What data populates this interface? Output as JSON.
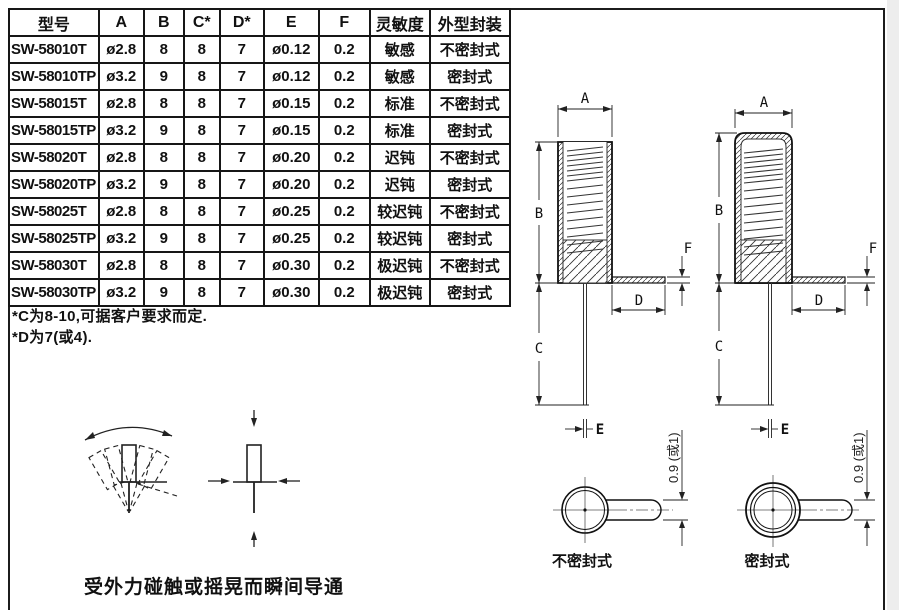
{
  "table": {
    "headers": [
      "型号",
      "A",
      "B",
      "C*",
      "D*",
      "E",
      "F",
      "灵敏度",
      "外型封装"
    ],
    "rows": [
      [
        "SW-58010T",
        "ø2.8",
        "8",
        "8",
        "7",
        "ø0.12",
        "0.2",
        "敏感",
        "不密封式"
      ],
      [
        "SW-58010TP",
        "ø3.2",
        "9",
        "8",
        "7",
        "ø0.12",
        "0.2",
        "敏感",
        "密封式"
      ],
      [
        "SW-58015T",
        "ø2.8",
        "8",
        "8",
        "7",
        "ø0.15",
        "0.2",
        "标准",
        "不密封式"
      ],
      [
        "SW-58015TP",
        "ø3.2",
        "9",
        "8",
        "7",
        "ø0.15",
        "0.2",
        "标准",
        "密封式"
      ],
      [
        "SW-58020T",
        "ø2.8",
        "8",
        "8",
        "7",
        "ø0.20",
        "0.2",
        "迟钝",
        "不密封式"
      ],
      [
        "SW-58020TP",
        "ø3.2",
        "9",
        "8",
        "7",
        "ø0.20",
        "0.2",
        "迟钝",
        "密封式"
      ],
      [
        "SW-58025T",
        "ø2.8",
        "8",
        "8",
        "7",
        "ø0.25",
        "0.2",
        "较迟钝",
        "不密封式"
      ],
      [
        "SW-58025TP",
        "ø3.2",
        "9",
        "8",
        "7",
        "ø0.25",
        "0.2",
        "较迟钝",
        "密封式"
      ],
      [
        "SW-58030T",
        "ø2.8",
        "8",
        "8",
        "7",
        "ø0.30",
        "0.2",
        "极迟钝",
        "不密封式"
      ],
      [
        "SW-58030TP",
        "ø3.2",
        "9",
        "8",
        "7",
        "ø0.30",
        "0.2",
        "极迟钝",
        "密封式"
      ]
    ]
  },
  "notes": [
    "*C为8-10,可据客户要求而定.",
    "*D为7(或4)."
  ],
  "caption": "受外力碰触或摇晃而瞬间导通",
  "drawings": {
    "dims": {
      "a": "A",
      "b": "B",
      "c": "C",
      "d": "D",
      "e": "E",
      "f": "F"
    },
    "lead_width_label": "0.9 (或1)",
    "unsealed_label": "不密封式",
    "sealed_label": "密封式"
  },
  "line_color": "#222222"
}
